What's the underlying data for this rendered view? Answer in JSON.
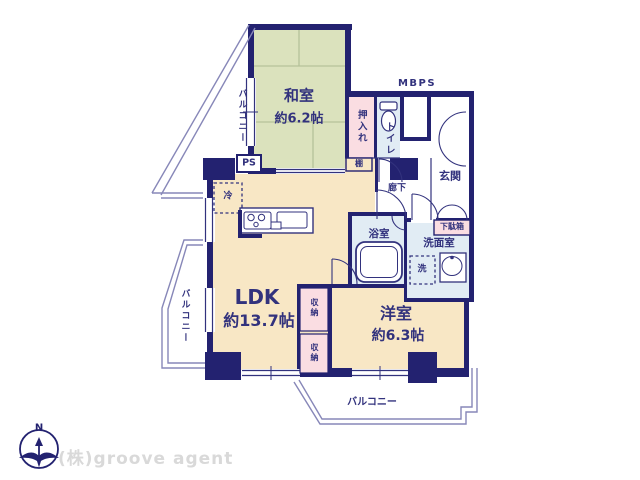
{
  "floorplan": {
    "rooms": {
      "washitsu": {
        "name": "和室",
        "size": "約6.2帖"
      },
      "ldk": {
        "name": "LDK",
        "size": "約13.7帖"
      },
      "youshitsu": {
        "name": "洋室",
        "size": "約6.3帖"
      },
      "genkan": "玄関",
      "rouka": "廊下",
      "toilet": "トイレ",
      "yokushitsu": "浴室",
      "senmenshitsu": "洗面室"
    },
    "storage": {
      "oshiire": "押入れ",
      "getabako": "下駄箱",
      "shuno_upper": "収納",
      "shuno_lower": "収納",
      "tana": "棚"
    },
    "fixtures": {
      "rei": "冷",
      "sen": "洗"
    },
    "shafts": {
      "ps": "PS",
      "mbps": "MBPS"
    },
    "balconies": {
      "upper_left": "バルコニー",
      "left": "バルコニー",
      "bottom": "バルコニー"
    },
    "compass": {
      "north": "N"
    },
    "watermark": "(株)groove agent",
    "colors": {
      "wall": "#232270",
      "tatami_room": "#dbe2bd",
      "flooring": "#f8e7c5",
      "closet": "#fadde2",
      "wet_area": "#e1ecf4",
      "label_text": "#32327d",
      "balcony_line": "#8787b8",
      "watermark_text": "#d9d9d9"
    }
  }
}
